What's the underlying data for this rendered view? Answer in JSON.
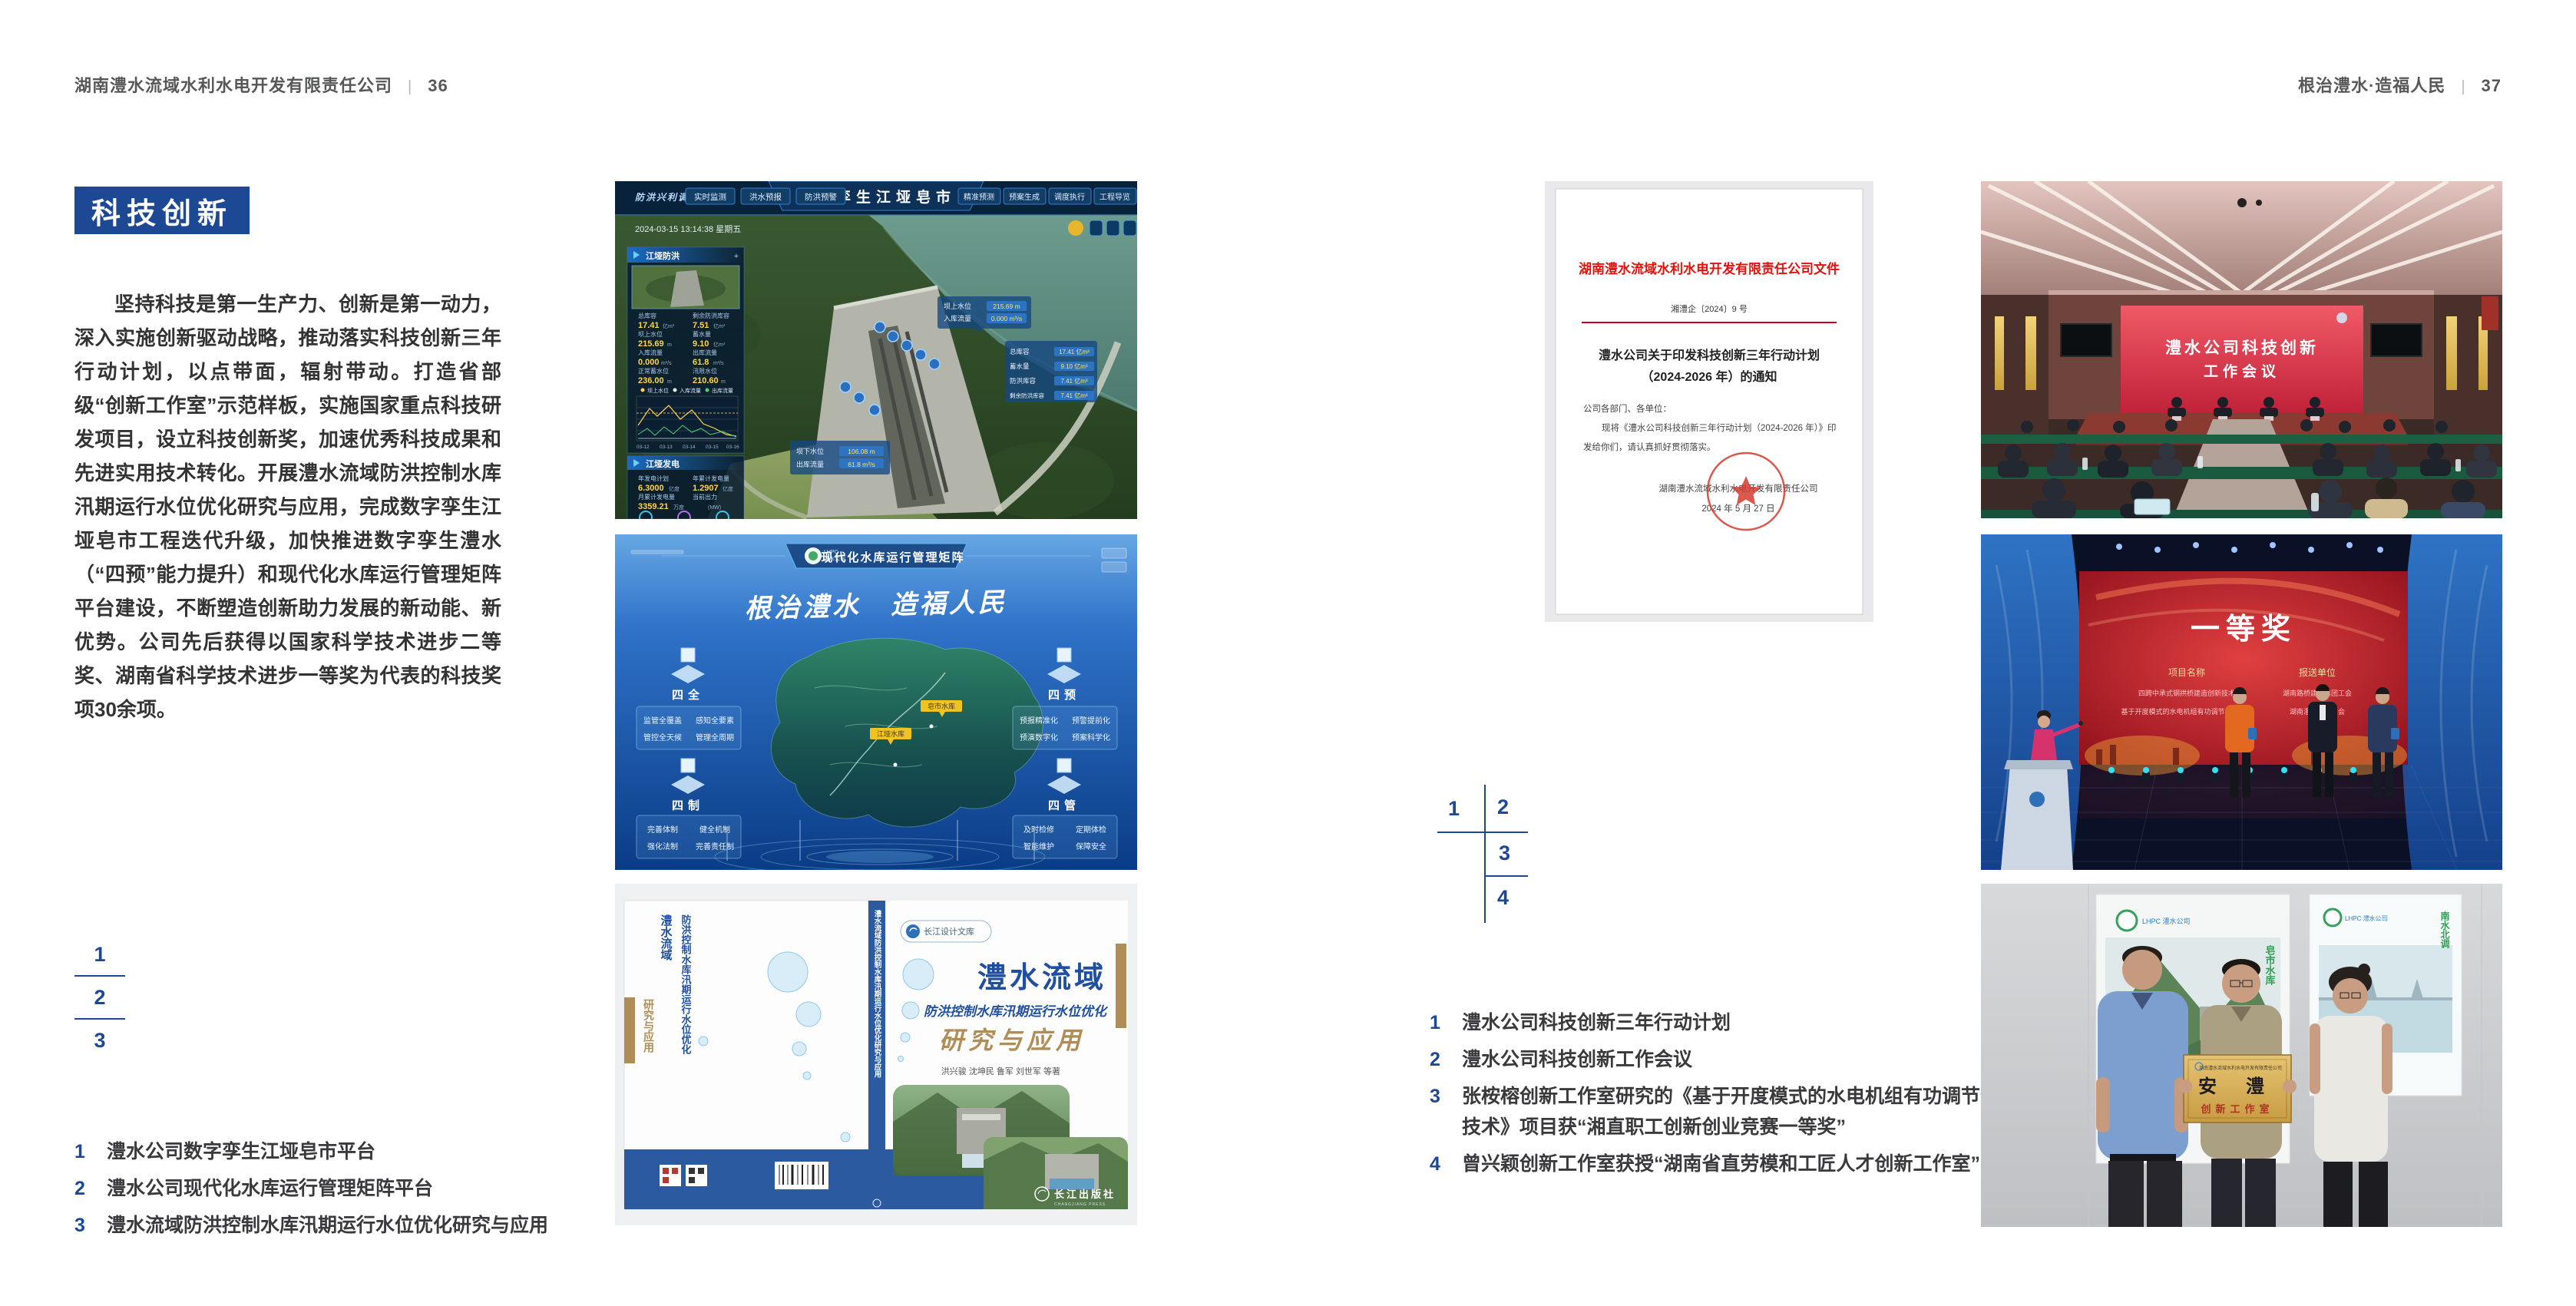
{
  "page_left": {
    "header": {
      "company": "湖南澧水流域水利水电开发有限责任公司",
      "divider": "|",
      "page_number": "36"
    },
    "section_title": "科技创新",
    "body_paragraph": "坚持科技是第一生产力、创新是第一动力，深入实施创新驱动战略，推动落实科技创新三年行动计划，以点带面，辐射带动。打造省部级“创新工作室”示范样板，实施国家重点科技研发项目，设立科技创新奖，加速优秀科技成果和先进实用技术转化。开展澧水流域防洪控制水库汛期运行水位优化研究与应用，完成数字孪生江垭皂市工程迭代升级，加快推进数字孪生澧水（“四预”能力提升）和现代化水库运行管理矩阵平台建设，不断塑造创新助力发展的新动能、新优势。公司先后获得以国家科学技术进步二等奖、湖南省科学技术进步一等奖为代表的科技奖项30余项。",
    "figure_keys": [
      "1",
      "2",
      "3"
    ],
    "captions": [
      {
        "num": "1",
        "text": "澧水公司数字孪生江垭皂市平台"
      },
      {
        "num": "2",
        "text": "澧水公司现代化水库运行管理矩阵平台"
      },
      {
        "num": "3",
        "text": "澧水流域防洪控制水库汛期运行水位优化研究与应用"
      }
    ]
  },
  "page_right": {
    "header": {
      "slogan": "根治澧水·造福人民",
      "divider": "|",
      "page_number": "37"
    },
    "figure_keys": [
      "1",
      "2",
      "3",
      "4"
    ],
    "captions": [
      {
        "num": "1",
        "text": "澧水公司科技创新三年行动计划"
      },
      {
        "num": "2",
        "text": "澧水公司科技创新工作会议"
      },
      {
        "num": "3",
        "text": "张桉榕创新工作室研究的《基于开度模式的水电机组有功调节优化技术》项目获“湘直职工创新创业竞赛一等奖”"
      },
      {
        "num": "4",
        "text": "曾兴颖创新工作室获授“湖南省直劳模和工匠人才创新工作室”"
      }
    ]
  },
  "figures": {
    "dashboard": {
      "title": "数字孪生江垭皂市",
      "badge": "防洪兴利调度",
      "tabs_left": [
        "实时监测",
        "洪水预报",
        "防洪预警"
      ],
      "tabs_right": [
        "精准预测",
        "预案生成",
        "调度执行",
        "工程导览"
      ],
      "timestamp": "2024-03-15 13:14:38 星期五",
      "panel1": {
        "title": "江垭防洪",
        "rows": [
          {
            "label": "总库容",
            "value": "17.41",
            "unit": "亿m³"
          },
          {
            "label": "剩余防洪库容",
            "value": "7.51",
            "unit": "亿m³"
          },
          {
            "label": "坝上水位",
            "value": "215.69",
            "unit": "m"
          },
          {
            "label": "蓄水量",
            "value": "9.10",
            "unit": "亿m³"
          },
          {
            "label": "入库流量",
            "value": "0.000",
            "unit": "m³/s"
          },
          {
            "label": "出库流量",
            "value": "61.8",
            "unit": "m³/s"
          },
          {
            "label": "正常蓄水位",
            "value": "236.00",
            "unit": "m"
          },
          {
            "label": "汛限水位",
            "value": "210.60",
            "unit": "m"
          }
        ]
      },
      "chart": {
        "legend": [
          "坝上水位",
          "入库流量",
          "出库流量"
        ],
        "xticks": [
          "03-12",
          "03-13",
          "03-14",
          "03-15",
          "03-16"
        ]
      },
      "panel2": {
        "title": "江垭发电",
        "rows": [
          {
            "label": "年发电计划",
            "value": "6.3000",
            "unit": "亿度"
          },
          {
            "label": "年累计发电量",
            "value": "1.2907",
            "unit": "亿度"
          },
          {
            "label": "月累计发电量",
            "value": "3359.21",
            "unit": "万度"
          },
          {
            "label": "当前出力",
            "value": "",
            "unit": "(MW)"
          }
        ]
      },
      "tags": {
        "tag1": [
          {
            "label": "坝上水位",
            "value": "215.69 m"
          },
          {
            "label": "入库流量",
            "value": "0.000 m³/s"
          }
        ],
        "tag2": [
          {
            "label": "总库容",
            "value": "17.41 亿m³"
          },
          {
            "label": "蓄水量",
            "value": "9.10 亿m³"
          },
          {
            "label": "防洪库容",
            "value": "7.41 亿m³"
          },
          {
            "label": "剩余防洪库容",
            "value": "7.41 亿m³"
          }
        ],
        "tag3": [
          {
            "label": "坝下水位",
            "value": "106.08 m"
          },
          {
            "label": "出库流量",
            "value": "61.8 m³/s"
          }
        ]
      }
    },
    "matrix": {
      "logo_top": "LHPC",
      "logo_sub": "澧水公司",
      "title": "现代化水库运行管理矩阵",
      "slogan": "根治澧水　造福人民",
      "groups": [
        {
          "name": "四全",
          "items": [
            "监管全覆盖",
            "感知全要素",
            "管控全天候",
            "管理全周期"
          ]
        },
        {
          "name": "四预",
          "items": [
            "预报精准化",
            "预警提前化",
            "预演数字化",
            "预案科学化"
          ]
        },
        {
          "name": "四制",
          "items": [
            "完善体制",
            "健全机制",
            "强化法制",
            "完善责任制"
          ]
        },
        {
          "name": "四管",
          "items": [
            "及时检修",
            "定期体检",
            "智能维护",
            "保障安全"
          ]
        }
      ],
      "map_labels": [
        "皂市水库",
        "江垭水库"
      ]
    },
    "book": {
      "series": "长江设计文库",
      "title": "澧水流域",
      "subtitle": "防洪控制水库汛期运行水位优化",
      "title2": "研究与应用",
      "authors": "洪兴骏 沈坤民 鲁军 刘世军 等著",
      "publisher": "长江出版社",
      "publisher_en": "CHANGJIANG PRESS",
      "spine": "澧水流域防洪控制水库汛期运行水位优化研究与应用",
      "back_col1": "澧水流域",
      "back_col2": "防洪控制水库汛期运行水位优化",
      "back_col3": "研究与应用"
    },
    "document": {
      "header": "湖南澧水流域水利水电开发有限责任公司文件",
      "doc_no": "湘澧企〔2024〕9 号",
      "title1": "澧水公司关于印发科技创新三年行动计划",
      "title2": "（2024-2026 年）的通知",
      "salutation": "公司各部门、各单位：",
      "body1": "现将《澧水公司科技创新三年行动计划（2024-2026 年）》印",
      "body2": "发给你们，请认真抓好贯彻落实。",
      "signer": "湖南澧水流域水利水电开发有限责任公司",
      "date": "2024 年 5 月 27 日"
    },
    "meeting": {
      "screen_line1": "澧水公司科技创新",
      "screen_line2": "工作会议"
    },
    "stage": {
      "award": "一等奖",
      "col1_header": "项目名称",
      "col2_header": "报送单位",
      "col1_lines": [
        "四跨中承式钢拱桥建造创新技术",
        "基于开度模式的水电机组有功调节优化技术"
      ],
      "col2_lines": [
        "湖南路桥建设集团工会",
        "湖南澧水公司工会"
      ]
    },
    "plaque": {
      "org": "湖南澧水流域水利水电开发有限责任公司",
      "name": "安 澧",
      "title": "创新工作室",
      "poster1_logo": "LHPC 澧水公司",
      "poster1_vertical": "皂市水库",
      "poster2_logo": "LHPC 澧水公司",
      "poster2_vertical": "南水北调"
    }
  },
  "colors": {
    "accent_blue": "#1d4994",
    "doc_red": "#e3120b",
    "header_gray": "#57585a"
  }
}
